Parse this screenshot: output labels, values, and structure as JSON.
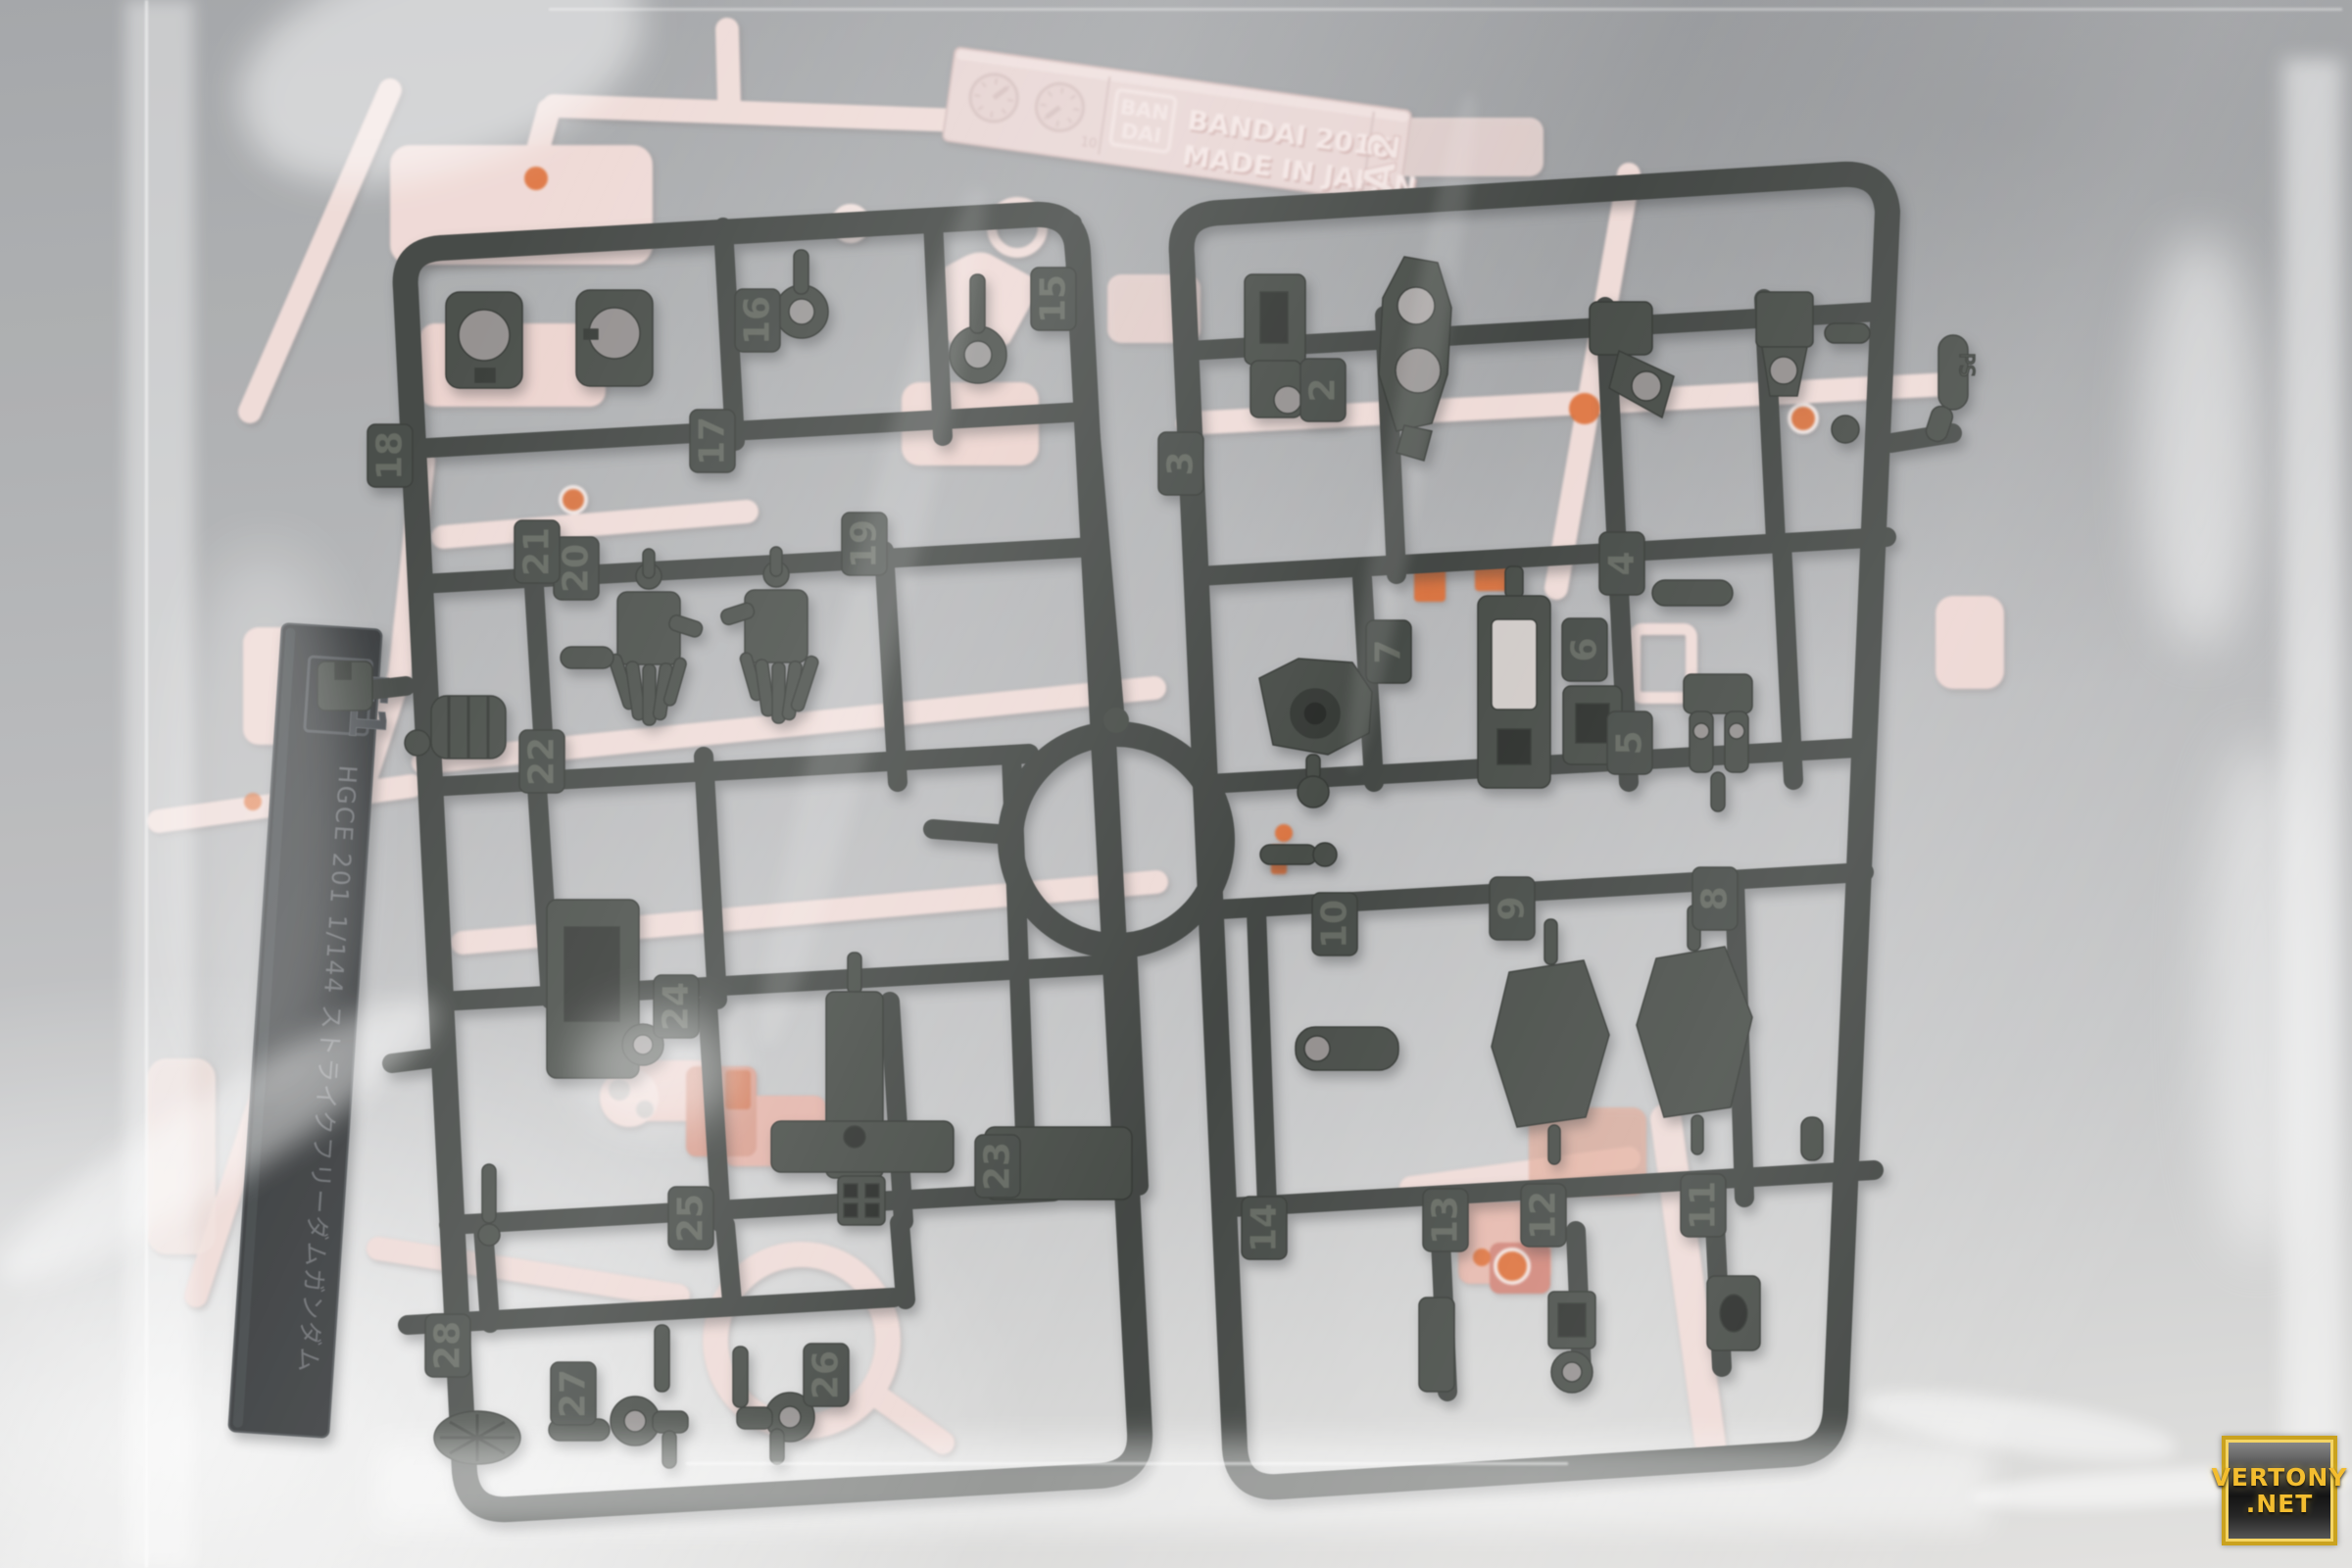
{
  "bandai_tag": {
    "logo_line1": "BAN",
    "logo_line2": "DAI",
    "line1": "BANDAI 2016",
    "line2": "MADE IN JAPAN",
    "runner_code": "A2",
    "dial_small_mark": "10"
  },
  "e1_tag": {
    "runner_code": "E1",
    "engraving": "HGCE 201 1/144 ストライクフリーダムガンダム"
  },
  "mold_mark": "PS",
  "runner": {
    "left_numbers": [
      "15",
      "16",
      "17",
      "18",
      "19",
      "20",
      "21",
      "22",
      "23",
      "24",
      "25",
      "26",
      "27",
      "28"
    ],
    "right_numbers": [
      "2",
      "3",
      "4",
      "5",
      "6",
      "7",
      "8",
      "9",
      "10",
      "11",
      "12",
      "13",
      "14"
    ]
  },
  "watermark": {
    "line1": "VERTONY",
    "line2": ".NET"
  },
  "colors": {
    "dark_plastic": "#3c403d",
    "dark_plastic_edge": "#565c56",
    "pink_plastic": "#eed9d5",
    "pink_deep": "#e2b3a9",
    "orange_accent": "#dd6a31",
    "tag_pink": "#e7d4d2",
    "bag_gray": "#b3b5b7",
    "watermark_gold": "#f2bd39",
    "watermark_border": "#d9a62e"
  }
}
